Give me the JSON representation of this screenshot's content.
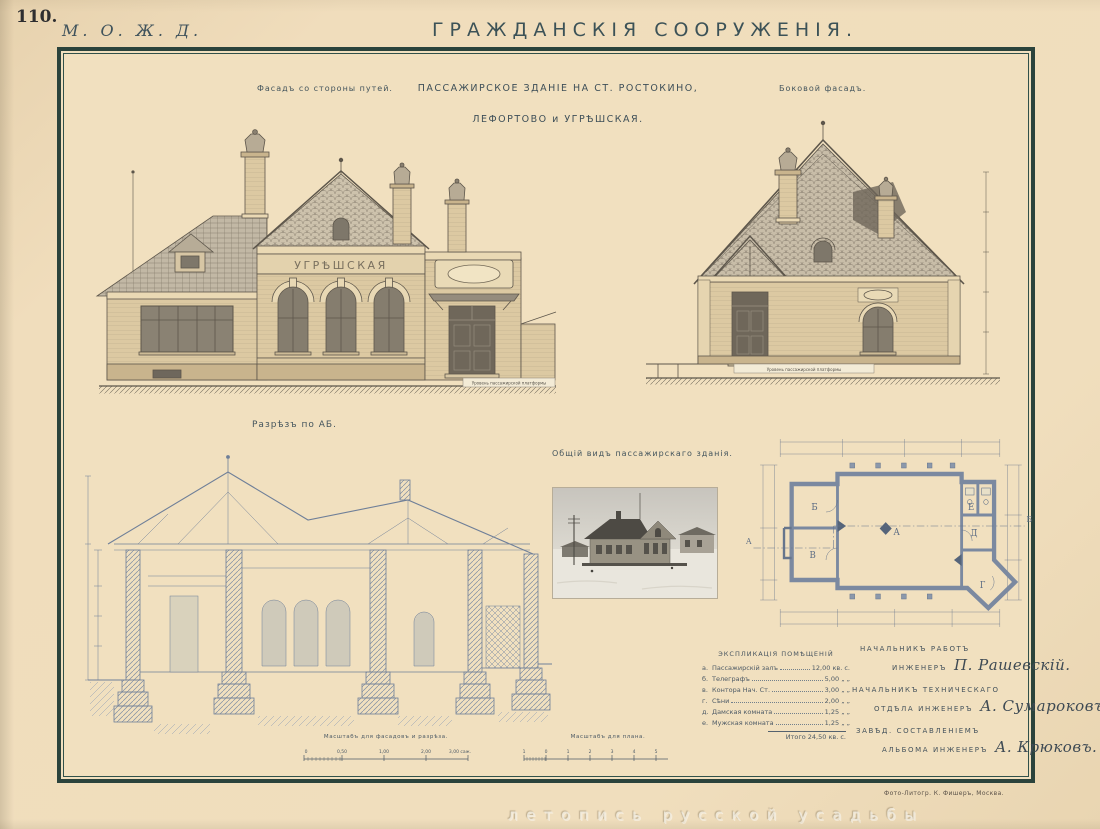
{
  "page": {
    "plate_number": "110.",
    "series": "М. О. Ж. Д.",
    "title": "ГРАЖДАНСКІЯ СООРУЖЕНІЯ.",
    "imprint": "Фото-Литогр. К. Фишеръ, Москва.",
    "watermark": "летопись русской усадьбы"
  },
  "headings": {
    "front_elevation": "Фасадъ со стороны путей.",
    "building_line1": "ПАССАЖИРСКОЕ ЗДАНІЕ НА СТ. РОСТОКИНО,",
    "building_line2": "ЛЕФОРТОВО и УГРѢШСКАЯ.",
    "side_elevation": "Боковой фасадъ.",
    "section": "Разрѣзъ по АБ.",
    "photo": "Общій видъ пассажирскаго зданія."
  },
  "elevation": {
    "station_sign": "УГРѢШСКАЯ",
    "platform_note": "Уровень пассажирской платформы"
  },
  "plan": {
    "section_marker_left": "А",
    "section_marker_right": "Б",
    "rooms": {
      "hall": "А",
      "telegraph": "Б",
      "office": "В",
      "entry": "Г",
      "ladies": "Д",
      "gents": "Е"
    }
  },
  "explication": {
    "title": "ЭКСПЛИКАЦІЯ ПОМѢЩЕНІЙ",
    "rows": [
      {
        "index": "а.",
        "name": "Пассажирскій залъ",
        "value": "12,00 кв. с."
      },
      {
        "index": "б.",
        "name": "Телеграфъ",
        "value": "5,00 „ „"
      },
      {
        "index": "в.",
        "name": "Контора Нач. Ст.",
        "value": "3,00 „ „"
      },
      {
        "index": "г.",
        "name": "Сѣни",
        "value": "2,00 „ „"
      },
      {
        "index": "д.",
        "name": "Дамская комната",
        "value": "1,25 „ „"
      },
      {
        "index": "е.",
        "name": "Мужская комната",
        "value": "1,25 „ „"
      }
    ],
    "total": "Итого 24,50 кв. с."
  },
  "scales": {
    "facade": {
      "label": "Масштабъ для фасадовъ и разрѣза.",
      "ticks": [
        "0",
        "0,50",
        "1,00",
        "2,00",
        "3,00 саж."
      ]
    },
    "plan": {
      "label": "Масштабъ для плана.",
      "ticks": [
        "1",
        "0",
        "1",
        "2",
        "3",
        "4",
        "5"
      ]
    }
  },
  "signatures": [
    {
      "role_line1": "НАЧАЛЬНИКЪ РАБОТЪ",
      "role_line2": "ИНЖЕНЕРЪ",
      "name": "П. Рашевскій."
    },
    {
      "role_line1": "НАЧАЛЬНИКЪ ТЕХНИЧЕСКАГО",
      "role_line2": "ОТДѢЛА ИНЖЕНЕРЪ",
      "name": "А. Сумароковъ"
    },
    {
      "role_line1": "ЗАВѢД. СОСТАВЛЕНІЕМЪ",
      "role_line2": "АЛЬБОМА ИНЖЕНЕРЪ",
      "name": "А. Крюковъ."
    }
  ],
  "colors": {
    "paper": "#f0ddbc",
    "frame": "#2b433c",
    "ink_sepia": "#5d564b",
    "ink_blue": "#6f7f98",
    "wall_tan": "#dcc9a2"
  }
}
